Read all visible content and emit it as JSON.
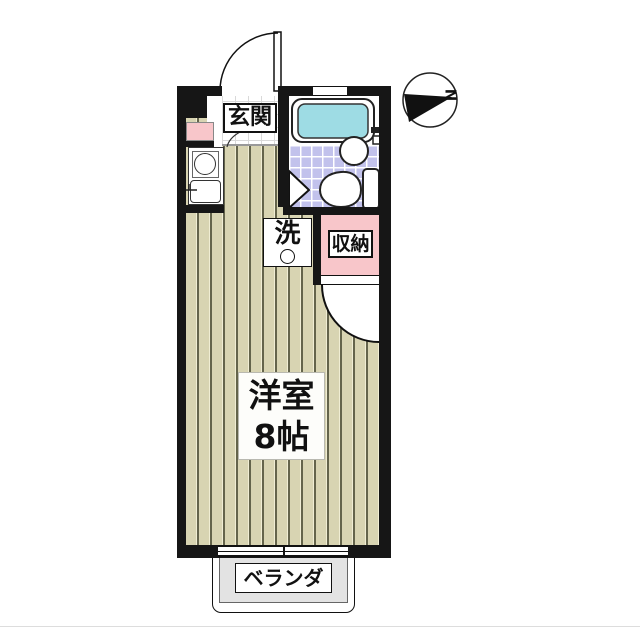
{
  "floorplan": {
    "labels": {
      "entrance": "玄関",
      "room_name": "洋室",
      "room_size": "8帖",
      "closet": "収納",
      "laundry": "洗",
      "balcony": "ベランダ",
      "compass_north": "N"
    },
    "colors": {
      "wall": "#161616",
      "wood_floor": "#d8d4b2",
      "bath_tile": "#c2c2ec",
      "accent_pink": "#f8c6ca",
      "bathtub": "#9edce4",
      "balcony_gray": "#e3e3e3"
    },
    "fixtures": [
      "bathtub",
      "toilet",
      "wash-basin",
      "kitchen-burner",
      "kitchen-sink",
      "washing-machine-space",
      "entrance-door",
      "closet-door",
      "bathroom-folding-door",
      "balcony-window",
      "top-window",
      "compass"
    ]
  }
}
